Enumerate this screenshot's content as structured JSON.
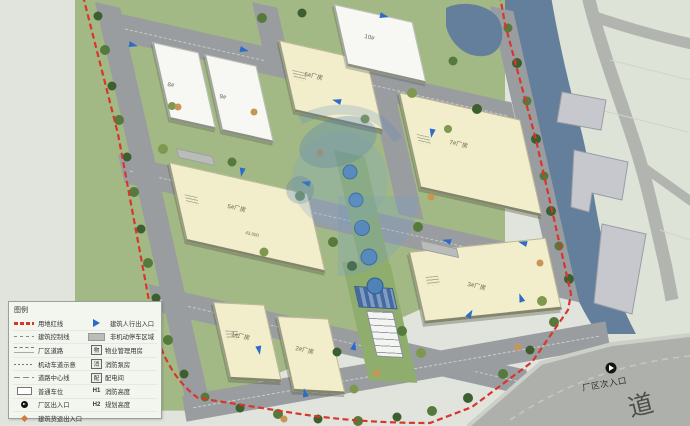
{
  "legend": {
    "title": "图例",
    "left_items": [
      {
        "symbol": "site-red-line",
        "label": "用地红线"
      },
      {
        "symbol": "building-control-line",
        "label": "建筑控制线"
      },
      {
        "symbol": "factory-road",
        "label": "厂区道路"
      },
      {
        "symbol": "motor-lane",
        "label": "机动车道示意"
      },
      {
        "symbol": "road-centerline",
        "label": "道路中心线"
      },
      {
        "symbol": "parking-space",
        "label": "普通车位"
      },
      {
        "symbol": "factory-gate",
        "label": "厂区出入口"
      },
      {
        "symbol": "freight-entrance",
        "label": "建筑货运出入口"
      }
    ],
    "right_items": [
      {
        "symbol": "pedestrian-entrance",
        "label": "建筑人行出入口"
      },
      {
        "symbol": "non-motor-parking",
        "label": "非机动停车区域"
      },
      {
        "symbol": "badge",
        "badge": "物",
        "label": "物业管理用房"
      },
      {
        "symbol": "badge",
        "badge": "消",
        "label": "消防泵房"
      },
      {
        "symbol": "badge",
        "badge": "配",
        "label": "配电间"
      },
      {
        "symbol": "text",
        "badge": "H1",
        "label": "消防高度"
      },
      {
        "symbol": "text",
        "badge": "H2",
        "label": "规划高度"
      }
    ]
  },
  "map": {
    "buildings": [
      {
        "label": "8#"
      },
      {
        "label": "9#"
      },
      {
        "label": "6#厂房"
      },
      {
        "label": "10#"
      },
      {
        "label": "7#厂房"
      },
      {
        "label": "3#厂房"
      },
      {
        "label": "5#厂房"
      },
      {
        "label": "1#厂房"
      },
      {
        "label": "2#厂房"
      }
    ],
    "dimension_label": "43.000",
    "secondary_entrance": "厂区次入口",
    "road_name_char": "道"
  },
  "colors": {
    "boundary_red": "#d9352b",
    "river_blue": "#647f9b",
    "building_cream": "#f2edca",
    "road_gray": "#9a9da0",
    "greenery": "#8fae6e",
    "entrance_blue": "#2e6bc8",
    "watermark_blue": "#5b87c0"
  }
}
